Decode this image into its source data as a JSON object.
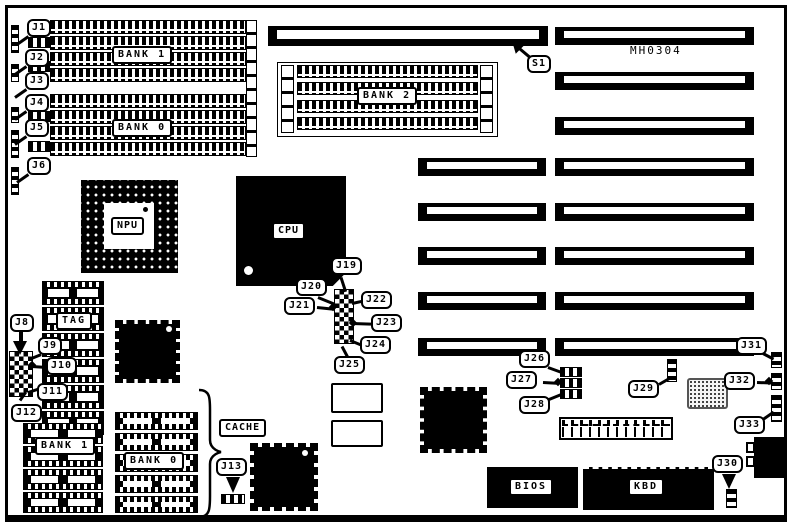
{
  "diagram": {
    "type": "motherboard-layout",
    "part_number": "MH0304"
  },
  "labels": {
    "s1": "S1",
    "j1": "J1",
    "j2": "J2",
    "j3": "J3",
    "j4": "J4",
    "j5": "J5",
    "j6": "J6",
    "j8": "J8",
    "j9": "J9",
    "j10": "J10",
    "j11": "J11",
    "j12": "J12",
    "j13": "J13",
    "j19": "J19",
    "j20": "J20",
    "j21": "J21",
    "j22": "J22",
    "j23": "J23",
    "j24": "J24",
    "j25": "J25",
    "j26": "J26",
    "j27": "J27",
    "j28": "J28",
    "j29": "J29",
    "j30": "J30",
    "j31": "J31",
    "j32": "J32",
    "j33": "J33",
    "npu": "NPU",
    "cpu": "CPU",
    "tag": "TAG",
    "cache": "CACHE",
    "bios": "BIOS",
    "kbd": "KBD",
    "bank0": "BANK 0",
    "bank1": "BANK 1",
    "bank2": "BANK 2"
  },
  "colors": {
    "ink": "#000000",
    "paper": "#ffffff"
  }
}
